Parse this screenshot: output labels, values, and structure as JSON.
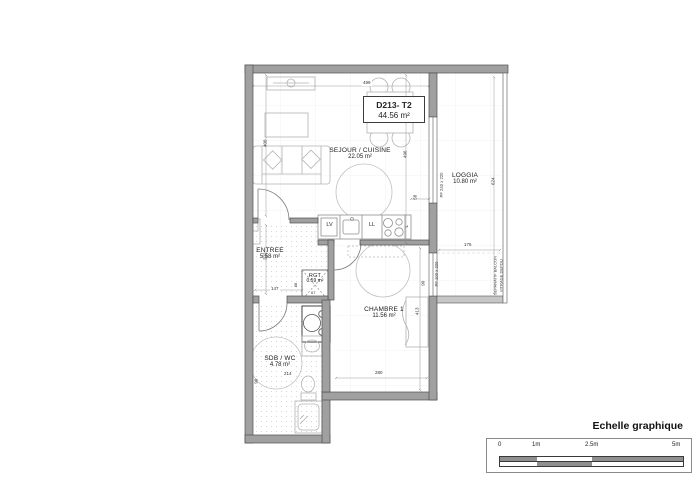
{
  "title_box": {
    "code": "D213- T2",
    "area": "44.56 m²"
  },
  "rooms": {
    "sejour": {
      "name": "SEJOUR / CUISINE",
      "area": "22.05 m²"
    },
    "loggia": {
      "name": "LOGGIA",
      "area": "10.80 m²"
    },
    "entree": {
      "name": "ENTREE",
      "area": "5.58 m²"
    },
    "rgt": {
      "name": "RGT",
      "area": "0.59 m²"
    },
    "chambre": {
      "name": "CHAMBRE 1",
      "area": "11.56 m²"
    },
    "sdb": {
      "name": "SDB / WC",
      "area": "4.78 m²"
    }
  },
  "appliances": {
    "dishwasher": "LV",
    "washer": "LL",
    "fridge": "L"
  },
  "windows": {
    "sejour": "PF 240 x 220",
    "chambre": "PF 100 x 220",
    "chambre_sill": "90"
  },
  "separator": {
    "line1": "SEPARATIF BALCON",
    "line2": "VITRAGE DEPOLI"
  },
  "dimensions": {
    "sejour_top": "499",
    "sejour_left": "408",
    "sejour_right": "496",
    "counter_gap": "58",
    "loggia_height": "624",
    "loggia_width": "175",
    "entree_height": "222",
    "entree_width": "147",
    "rgt_width": "67",
    "rgt_depth": "88",
    "chambre_height": "413",
    "chambre_width": "280",
    "sdb_width": "214",
    "sdb_door": "90"
  },
  "scale_bar": {
    "title": "Echelle graphique",
    "ticks": [
      "0",
      "1m",
      "2.5m",
      "5m"
    ]
  },
  "colors": {
    "wall": "#a0a0a0",
    "wall_edge": "#4f4f4f",
    "furniture": "#b3b3b3",
    "separator_wall": "#c6c6c6"
  }
}
